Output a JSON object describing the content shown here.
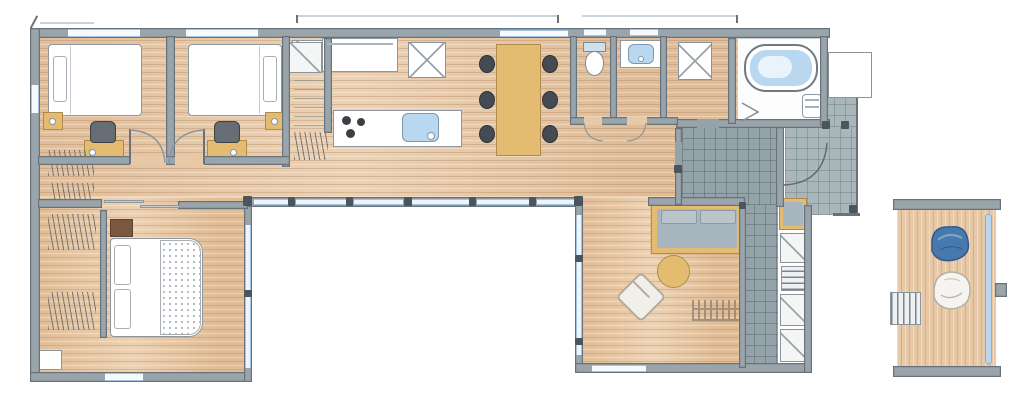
{
  "meta": {
    "type": "architectural-floor-plan",
    "style": "hand-drawn watercolor, single-story U-shaped house with inner courtyard and detached wood deck",
    "canvas": {
      "width": 1024,
      "height": 407
    },
    "visible_text": "none"
  },
  "palette": {
    "wood": "#e7c9a7",
    "wall": "#9aa4ab",
    "wallDark": "#68727a",
    "tile": "#94a3a9",
    "porch": "#a9b6ba",
    "glass": "#a3c3e0",
    "glassBg": "#eef4fa",
    "tan": "#e3bc72",
    "tanDark": "#b18b4e",
    "cushion": "#a7b6bf",
    "water": "#b9d7ef",
    "chairDark": "#454b52",
    "brown": "#7b5740",
    "beanbagBlue": "#4779ae"
  },
  "rooms": [
    {
      "id": "bedroom-1",
      "label": "bedroom 1",
      "furniture": [
        "single-bed",
        "pillow",
        "nightstand",
        "desk",
        "desk-chair"
      ]
    },
    {
      "id": "bedroom-2",
      "label": "bedroom 2",
      "furniture": [
        "single-bed",
        "pillow",
        "nightstand",
        "desk",
        "desk-chair"
      ]
    },
    {
      "id": "hall-closet",
      "label": "closet wall",
      "furniture": [
        "crossed-storage",
        "shelves",
        "hanger-hatch"
      ]
    },
    {
      "id": "kitchen",
      "label": "kitchen",
      "furniture": [
        "wall-counter",
        "refrigerator-x",
        "island-counter",
        "cooktop-3-burners",
        "kitchen-sink"
      ]
    },
    {
      "id": "dining",
      "label": "dining",
      "furniture": [
        "dining-table",
        "dining-chairs-x6"
      ]
    },
    {
      "id": "wc",
      "label": "toilet room",
      "furniture": [
        "toilet"
      ]
    },
    {
      "id": "washroom",
      "label": "washroom",
      "furniture": [
        "vanity-basin"
      ]
    },
    {
      "id": "utility",
      "label": "utility / laundry",
      "furniture": [
        "washer-x-box"
      ]
    },
    {
      "id": "bathroom",
      "label": "bathroom",
      "furniture": [
        "bathtub",
        "corner-basin",
        "folding-door-mark"
      ]
    },
    {
      "id": "entrance",
      "label": "genkan + tiled porch",
      "furniture": [
        "entry-door-swing",
        "shoe-bench",
        "tiled-floor"
      ]
    },
    {
      "id": "storage-wall",
      "label": "storage corridor wall",
      "furniture": [
        "closet-diagonal-x3",
        "ladder-rungs"
      ]
    },
    {
      "id": "living",
      "label": "living room",
      "furniture": [
        "wood-frame-sofa",
        "round-coffee-table",
        "lounge-armchair",
        "slat-rug"
      ]
    },
    {
      "id": "master-bedroom",
      "label": "master bedroom",
      "furniture": [
        "double-bed",
        "two-pillows",
        "dotted-duvet",
        "headboard-cabinet",
        "wardrobe-hatches",
        "sliding-door"
      ]
    },
    {
      "id": "courtyard",
      "label": "open courtyard (white)",
      "furniture": []
    },
    {
      "id": "deck",
      "label": "detached wood deck",
      "furniture": [
        "bean-bag",
        "lounge-chair",
        "access-steps",
        "water-channel"
      ]
    }
  ],
  "counts": {
    "dining_chairs": 6,
    "bedrooms": 3,
    "door_swings": 5,
    "courtyard_glass_panels": 6
  },
  "icons": [
    "bathtub-icon",
    "toilet-icon",
    "sink-icon",
    "cooktop-icon",
    "bed-icon",
    "sofa-icon",
    "table-icon",
    "chair-icon",
    "door-swing-icon",
    "closet-x-icon",
    "ladder-icon",
    "beanbag-icon"
  ]
}
